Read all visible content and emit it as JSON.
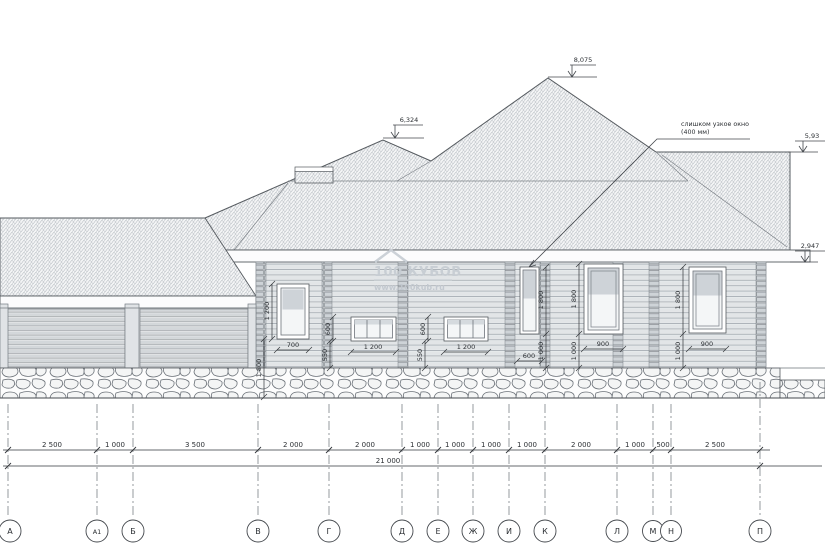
{
  "drawing": {
    "elevation_marks": {
      "main_ridge": "8,075",
      "small_ridge": "6,324",
      "right_roof_top": "5,93",
      "right_eaves": "2,947"
    },
    "annotation": {
      "line1": "слишком узкое окно",
      "line2": "(400 мм)"
    },
    "watermark": {
      "brand": "100 КУБОВ",
      "url": "www.100kub.ru"
    },
    "window_dims": {
      "w1": {
        "height": "1 200",
        "width": "700",
        "below": "1 800"
      },
      "w2": {
        "height": "600",
        "below": "550",
        "width": "1 200"
      },
      "w3": {
        "height": "600",
        "below": "550",
        "width": "1 200"
      },
      "w4": {
        "height": "1 800",
        "below": "1 000",
        "width": "600"
      },
      "w5": {
        "height": "1 800",
        "below": "1 000",
        "width": "900"
      },
      "w6": {
        "height": "1 800",
        "below": "1 000",
        "width": "900"
      }
    },
    "dimension_chain": {
      "segments": [
        "2 500",
        "1 000",
        "3 500",
        "2 000",
        "2 000",
        "1 000",
        "1 000",
        "1 000",
        "1 000",
        "2 000",
        "1 000",
        "500",
        "2 500"
      ],
      "total": "21 000"
    },
    "axes": [
      "А",
      "А1",
      "Б",
      "В",
      "Г",
      "Д",
      "Е",
      "Ж",
      "И",
      "К",
      "Л",
      "М",
      "Н",
      "П"
    ]
  }
}
